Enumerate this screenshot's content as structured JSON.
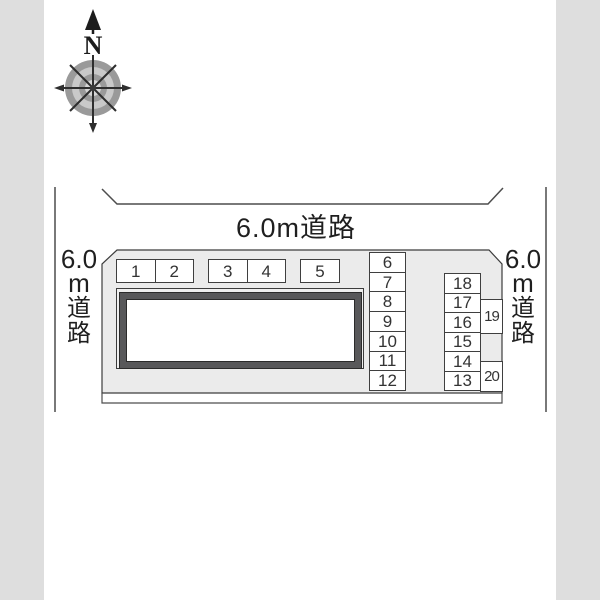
{
  "compass": {
    "north": "N"
  },
  "roads": {
    "top_label": "6.0m道路",
    "left_chars": [
      "6.0",
      "m",
      "道",
      "路"
    ],
    "right_chars": [
      "6.0",
      "m",
      "道",
      "路"
    ]
  },
  "parking": {
    "top_row": [
      "1",
      "2",
      "3",
      "4",
      "5"
    ],
    "left_column": [
      "6",
      "7",
      "8",
      "9",
      "10",
      "11",
      "12"
    ],
    "right_column": [
      "18",
      "17",
      "16",
      "15",
      "14",
      "13"
    ],
    "annex": [
      "19",
      "20"
    ]
  },
  "colors": {
    "side_band": "#dedede",
    "parcel_fill": "#ebebeb",
    "outline": "#3c3c3c",
    "building_frame": "#58585a",
    "compass_ring_dark": "#9a9a9a",
    "compass_ring_light": "#c9c9c9"
  }
}
